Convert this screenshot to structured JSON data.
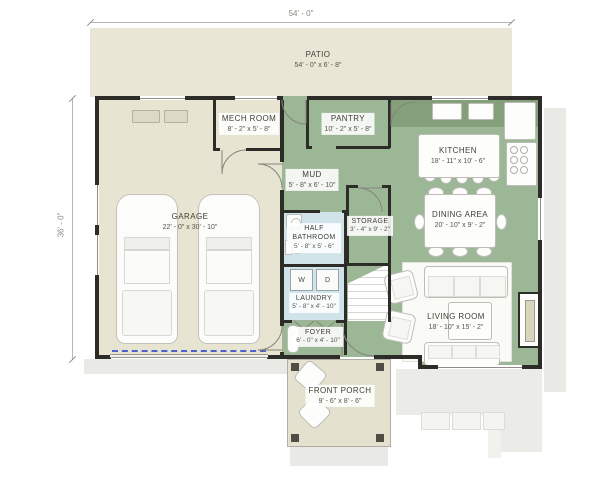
{
  "dimensions": {
    "top": "54' - 0\"",
    "left": "36' - 0\""
  },
  "rooms": {
    "patio": {
      "name": "PATIO",
      "dims": "54' - 0\" x 6' - 8\""
    },
    "mech_room": {
      "name": "MECH ROOM",
      "dims": "8' - 2\" x 5' - 8\""
    },
    "pantry": {
      "name": "PANTRY",
      "dims": "10' - 2\" x 5' - 8\""
    },
    "kitchen": {
      "name": "KITCHEN",
      "dims": "18' - 11\" x 10' - 6\""
    },
    "garage": {
      "name": "GARAGE",
      "dims": "22' - 0\" x 30' - 10\""
    },
    "mud": {
      "name": "MUD",
      "dims": "5' - 8\" x 6' - 10\""
    },
    "storage": {
      "name": "STORAGE",
      "dims": "3' - 4\" x 9' - 2\""
    },
    "half_bathroom": {
      "name": "HALF BATHROOM",
      "dims": "5' - 8\" x 5' - 6\""
    },
    "laundry": {
      "name": "LAUNDRY",
      "dims": "5' - 8\" x 4' - 10\""
    },
    "dining_area": {
      "name": "DINING AREA",
      "dims": "20' - 10\" x 9' - 2\""
    },
    "living_room": {
      "name": "LIVING ROOM",
      "dims": "18' - 10\" x 15' - 2\""
    },
    "foyer": {
      "name": "FOYER",
      "dims": "6' - 0\" x 4' - 10\""
    },
    "front_porch": {
      "name": "FRONT PORCH",
      "dims": "9' - 6\" x 8' - 6\""
    }
  },
  "appliances": {
    "washer": "W",
    "dryer": "D"
  },
  "colors": {
    "floor_living": "#9cb795",
    "floor_garage": "#e7e4d2",
    "floor_patio": "#e9e6d6",
    "floor_bath": "#cfe3e9",
    "wall": "#2e2c28",
    "counter": "#83a07b",
    "garage_door_dash": "#4a62c9"
  }
}
